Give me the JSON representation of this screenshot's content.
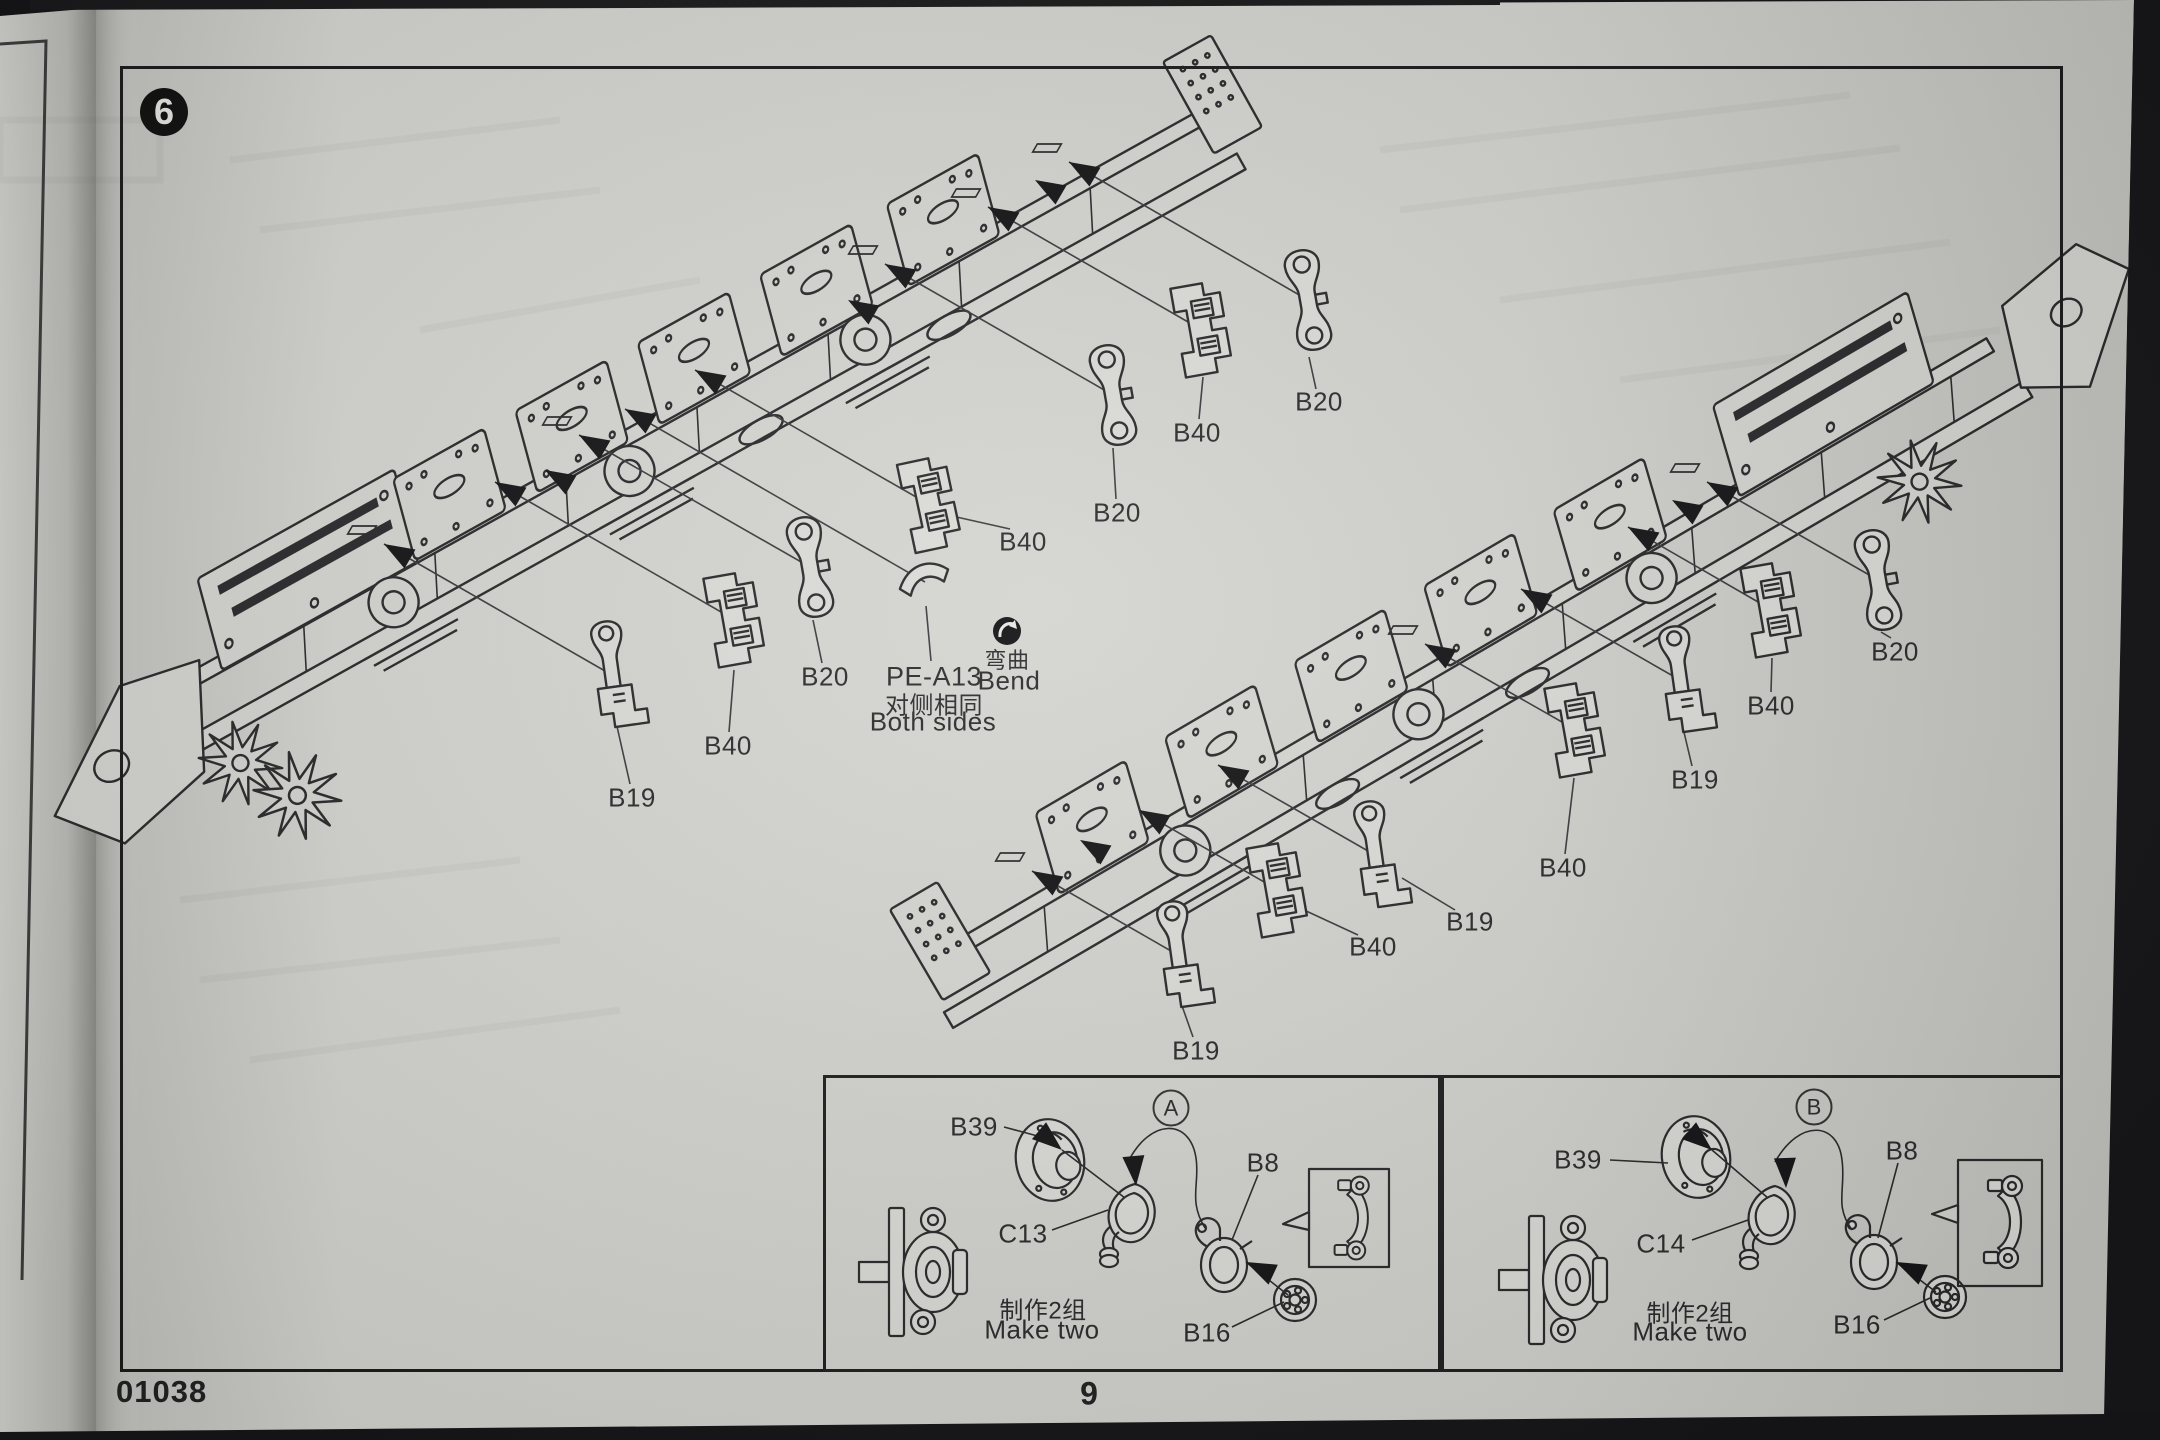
{
  "page": {
    "step": "6",
    "kit_number": "01038",
    "page_number": "9"
  },
  "diagram": {
    "part_labels": [
      {
        "text": "B20",
        "x": 1319,
        "y": 402
      },
      {
        "text": "B40",
        "x": 1197,
        "y": 433
      },
      {
        "text": "B20",
        "x": 1117,
        "y": 513
      },
      {
        "text": "B40",
        "x": 1023,
        "y": 542
      },
      {
        "text": "B20",
        "x": 825,
        "y": 677
      },
      {
        "text": "B40",
        "x": 728,
        "y": 746
      },
      {
        "text": "B19",
        "x": 632,
        "y": 798
      },
      {
        "text": "B20",
        "x": 1895,
        "y": 652
      },
      {
        "text": "B40",
        "x": 1771,
        "y": 706
      },
      {
        "text": "B19",
        "x": 1695,
        "y": 780
      },
      {
        "text": "B40",
        "x": 1563,
        "y": 868
      },
      {
        "text": "B19",
        "x": 1470,
        "y": 922
      },
      {
        "text": "B40",
        "x": 1373,
        "y": 947
      },
      {
        "text": "B19",
        "x": 1196,
        "y": 1051
      }
    ],
    "pe_note": {
      "part": "PE-A13",
      "zh": "对侧相同",
      "en": "Both sides"
    },
    "bend_badge": {
      "zh": "弯曲",
      "en": "Bend"
    }
  },
  "insets": [
    {
      "id": "A",
      "note_zh": "制作2组",
      "note_en": "Make two",
      "labels": [
        {
          "text": "B39",
          "x": 974,
          "y": 1127
        },
        {
          "text": "B8",
          "x": 1263,
          "y": 1163
        },
        {
          "text": "C13",
          "x": 1023,
          "y": 1234
        },
        {
          "text": "B16",
          "x": 1207,
          "y": 1333
        }
      ]
    },
    {
      "id": "B",
      "note_zh": "制作2组",
      "note_en": "Make two",
      "labels": [
        {
          "text": "B39",
          "x": 1578,
          "y": 1160
        },
        {
          "text": "B8",
          "x": 1902,
          "y": 1151
        },
        {
          "text": "C14",
          "x": 1661,
          "y": 1244
        },
        {
          "text": "B16",
          "x": 1857,
          "y": 1325
        }
      ]
    }
  ]
}
